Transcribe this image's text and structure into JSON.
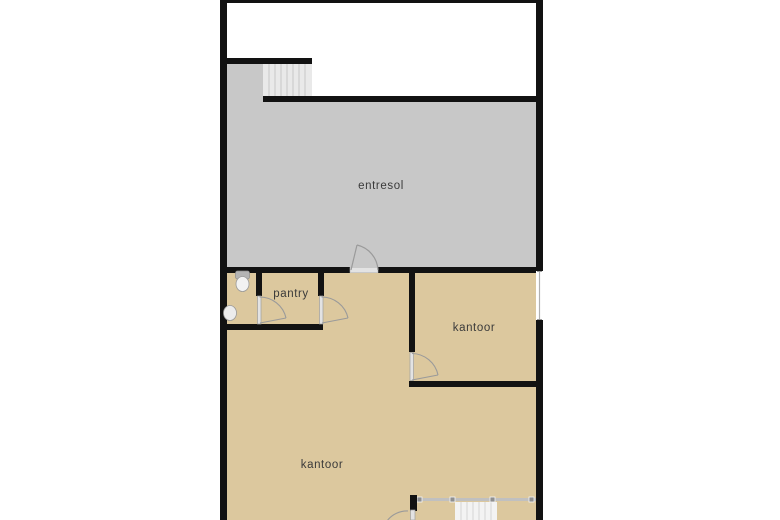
{
  "plan": {
    "type": "floorplan",
    "floor_labels": {
      "entresol": "entresol",
      "pantry": "pantry",
      "kantoor_right": "kantoor",
      "kantoor_main": "kantoor"
    },
    "features": {
      "upper_stairs": "staircase-to-mezzanine",
      "lower_stairs": "staircase-down-with-railing",
      "toilet": "toilet-fixture",
      "sink": "sink-fixture",
      "window_right": "window-in-right-wall"
    },
    "colors": {
      "background": "#ffffff",
      "wall": "#121212",
      "entresol_floor": "#c8c8c8",
      "office_floor": "#dcc89e",
      "stairs_upper": "#e9e9e9",
      "stairs_lower": "#f3f3f3",
      "stair_tread_line": "#c6c6c6",
      "door_fill": "#e3e3e3",
      "door_line": "#9a9a9a",
      "railing": "#c0c0c0",
      "railing_post": "#8f8f8f",
      "fixture_fill": "#f2f2f2",
      "fixture_dark": "#b4b4b4",
      "window_line": "#b0b0b0",
      "label_text": "#3a3a3a"
    }
  }
}
